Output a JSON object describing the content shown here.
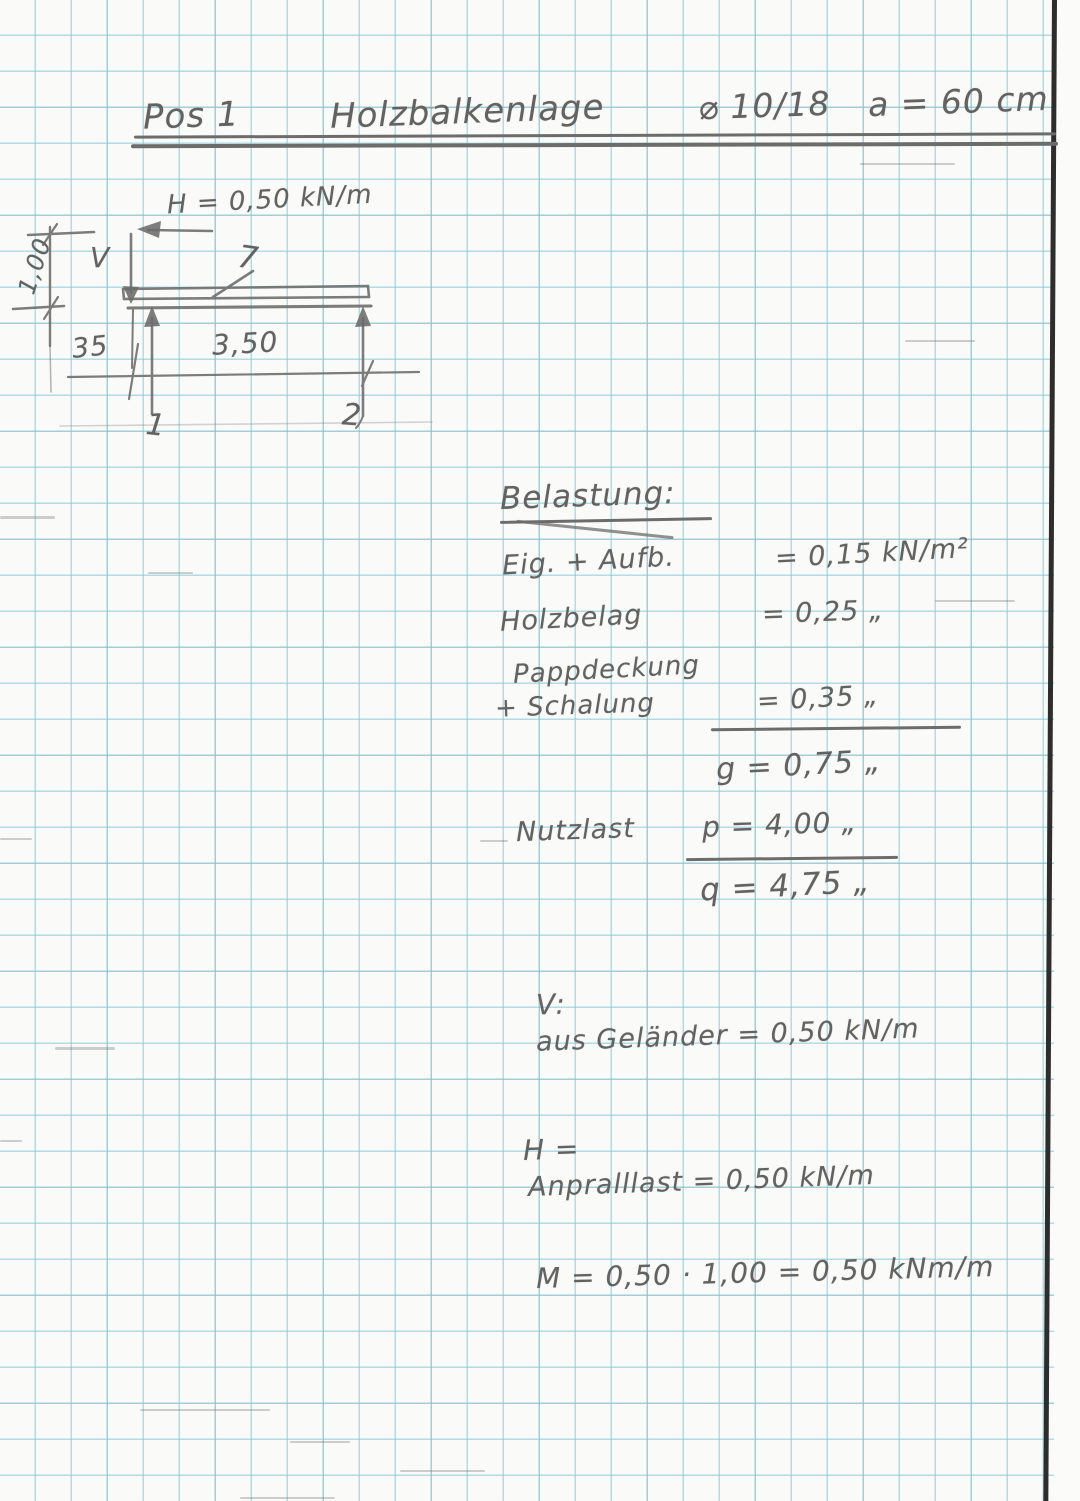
{
  "document": {
    "title": {
      "pos": "Pos 1",
      "subject": "Holzbalkenlage",
      "section": "⌀ 10/18",
      "spacing": "a = 60 cm"
    },
    "diagram": {
      "h_load": "H = 0,50 kN/m",
      "v_label": "V",
      "beam_pointer": "7",
      "dim_height": "1,00",
      "dim_left_offset": "35",
      "dim_span": "3,50",
      "support_left": "1",
      "support_right": "2"
    },
    "loads": {
      "heading": "Belastung:",
      "row1_label": "Eig. + Aufb.",
      "row1_value": "= 0,15 kN/m²",
      "row2_label": "Holzbelag",
      "row2_value": "= 0,25 „",
      "row3_label_line1": "Pappdeckung",
      "row3_label_line2": "+ Schalung",
      "row3_value": "= 0,35 „",
      "sum_dead": "g = 0,75 „",
      "row4_label": "Nutzlast",
      "row4_value": "p = 4,00 „",
      "sum_total": "q = 4,75 „"
    },
    "v_section": {
      "heading": "V:",
      "line": "aus Geländer = 0,50 kN/m"
    },
    "h_section": {
      "heading": "H =",
      "line": "Anpralllast = 0,50 kN/m"
    },
    "moment": {
      "line": "M = 0,50 · 1,00 = 0,50 kNm/m"
    }
  }
}
